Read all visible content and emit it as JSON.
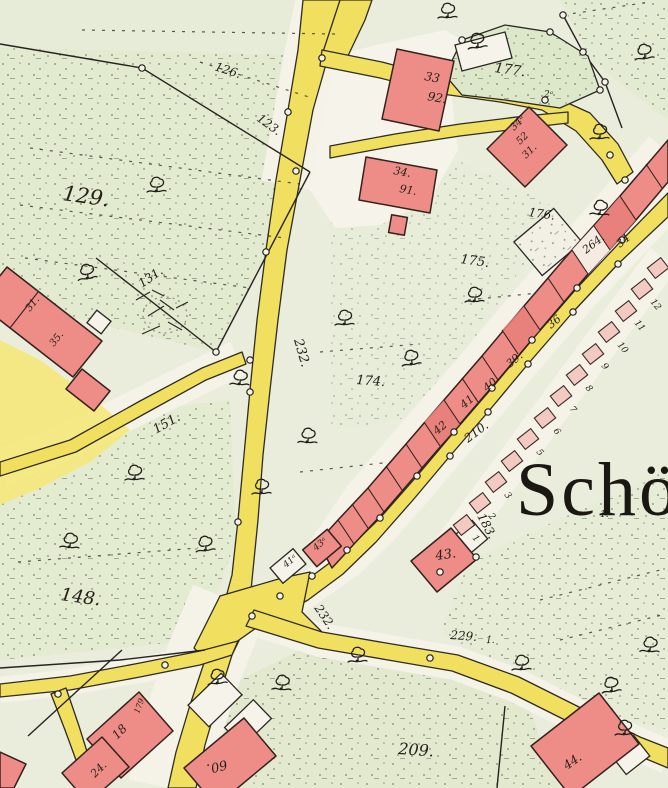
{
  "map": {
    "place_name": "Schö",
    "colors": {
      "road_yellow": "#f1e05f",
      "building_red": "#ee8d88",
      "plot_pink": "#f4c9c2",
      "field_green": "#e2ead0",
      "paper": "#eaeddc",
      "ink": "#241f18"
    },
    "labels": [
      {
        "text": "129.",
        "x": 62,
        "y": 200,
        "rot": 8,
        "size": 21,
        "cls": "parcel"
      },
      {
        "text": "126.",
        "x": 214,
        "y": 70,
        "rot": 18,
        "size": 12,
        "cls": "parcel"
      },
      {
        "text": "123.",
        "x": 256,
        "y": 120,
        "rot": 36,
        "size": 12,
        "cls": "parcel"
      },
      {
        "text": "131.",
        "x": 142,
        "y": 288,
        "rot": -35,
        "size": 12,
        "cls": "parcel"
      },
      {
        "text": "151.",
        "x": 156,
        "y": 434,
        "rot": -30,
        "size": 13,
        "cls": "parcel"
      },
      {
        "text": "148.",
        "x": 60,
        "y": 600,
        "rot": 8,
        "size": 18,
        "cls": "parcel"
      },
      {
        "text": "174.",
        "x": 356,
        "y": 384,
        "rot": 4,
        "size": 13,
        "cls": "parcel"
      },
      {
        "text": "175.",
        "x": 460,
        "y": 263,
        "rot": 8,
        "size": 13,
        "cls": "parcel"
      },
      {
        "text": "176.",
        "x": 528,
        "y": 216,
        "rot": 8,
        "size": 12,
        "cls": "parcel"
      },
      {
        "text": "177.",
        "x": 494,
        "y": 72,
        "rot": 8,
        "size": 14,
        "cls": "parcel"
      },
      {
        "text": "183.",
        "x": 477,
        "y": 516,
        "rot": 62,
        "size": 12,
        "cls": "parcel"
      },
      {
        "text": "209.",
        "x": 398,
        "y": 754,
        "rot": 4,
        "size": 16,
        "cls": "parcel"
      },
      {
        "text": "264.",
        "x": 586,
        "y": 254,
        "rot": -38,
        "size": 11,
        "cls": "parcel"
      },
      {
        "text": "1.",
        "x": 486,
        "y": 643,
        "rot": 0,
        "size": 9,
        "cls": "parcel"
      },
      {
        "text": "1.",
        "x": 600,
        "y": 517,
        "rot": 0,
        "size": 9,
        "cls": "parcel"
      },
      {
        "text": "2ᵃ",
        "x": 544,
        "y": 97,
        "rot": 0,
        "size": 9,
        "cls": "parcel"
      },
      {
        "text": "210.",
        "x": 468,
        "y": 443,
        "rot": -37,
        "size": 12,
        "cls": "road"
      },
      {
        "text": "229.",
        "x": 450,
        "y": 639,
        "rot": 4,
        "size": 12,
        "cls": "road"
      },
      {
        "text": "232.",
        "x": 294,
        "y": 340,
        "rot": 74,
        "size": 13,
        "cls": "road"
      },
      {
        "text": "232.",
        "x": 314,
        "y": 608,
        "rot": 56,
        "size": 12,
        "cls": "road"
      },
      {
        "text": "33",
        "x": 424,
        "y": 80,
        "rot": 10,
        "size": 12,
        "cls": "building"
      },
      {
        "text": "92.",
        "x": 427,
        "y": 100,
        "rot": 10,
        "size": 12,
        "cls": "building"
      },
      {
        "text": "34.",
        "x": 393,
        "y": 174,
        "rot": 10,
        "size": 11,
        "cls": "building"
      },
      {
        "text": "91.",
        "x": 399,
        "y": 192,
        "rot": 10,
        "size": 11,
        "cls": "building"
      },
      {
        "text": "34ᵃ",
        "x": 514,
        "y": 131,
        "rot": -45,
        "size": 10,
        "cls": "building"
      },
      {
        "text": "52",
        "x": 520,
        "y": 145,
        "rot": -45,
        "size": 10,
        "cls": "building"
      },
      {
        "text": "31.",
        "x": 526,
        "y": 159,
        "rot": -45,
        "size": 10,
        "cls": "building"
      },
      {
        "text": "34",
        "x": 620,
        "y": 248,
        "rot": -40,
        "size": 11,
        "cls": "building"
      },
      {
        "text": "36",
        "x": 551,
        "y": 329,
        "rot": -40,
        "size": 11,
        "cls": "building"
      },
      {
        "text": "39.",
        "x": 510,
        "y": 368,
        "rot": -40,
        "size": 11,
        "cls": "building"
      },
      {
        "text": "40",
        "x": 487,
        "y": 392,
        "rot": -40,
        "size": 11,
        "cls": "building"
      },
      {
        "text": "41.",
        "x": 464,
        "y": 409,
        "rot": -40,
        "size": 11,
        "cls": "building"
      },
      {
        "text": "42",
        "x": 437,
        "y": 435,
        "rot": -40,
        "size": 11,
        "cls": "building"
      },
      {
        "text": "43ᵃ",
        "x": 316,
        "y": 551,
        "rot": -40,
        "size": 9,
        "cls": "building"
      },
      {
        "text": "41ᵃ",
        "x": 286,
        "y": 568,
        "rot": -40,
        "size": 9,
        "cls": "building"
      },
      {
        "text": "43.",
        "x": 436,
        "y": 560,
        "rot": -8,
        "size": 13,
        "cls": "building"
      },
      {
        "text": "44.",
        "x": 567,
        "y": 770,
        "rot": -35,
        "size": 12,
        "cls": "building"
      },
      {
        "text": "18",
        "x": 117,
        "y": 740,
        "rot": -45,
        "size": 12,
        "cls": "building"
      },
      {
        "text": "24.",
        "x": 95,
        "y": 778,
        "rot": -45,
        "size": 11,
        "cls": "building"
      },
      {
        "text": "60.",
        "x": 226,
        "y": 760,
        "rot": 166,
        "size": 13,
        "cls": "building"
      },
      {
        "text": "179",
        "x": 139,
        "y": 714,
        "rot": -70,
        "size": 8,
        "cls": "building"
      },
      {
        "text": "31.",
        "x": 30,
        "y": 312,
        "rot": -52,
        "size": 10,
        "cls": "building"
      },
      {
        "text": "35.",
        "x": 54,
        "y": 347,
        "rot": -52,
        "size": 10,
        "cls": "building"
      },
      {
        "text": "12",
        "x": 650,
        "y": 302,
        "rot": 50,
        "size": 9,
        "cls": "plot"
      },
      {
        "text": "11",
        "x": 634,
        "y": 323,
        "rot": 50,
        "size": 9,
        "cls": "plot"
      },
      {
        "text": "10",
        "x": 617,
        "y": 345,
        "rot": 50,
        "size": 9,
        "cls": "plot"
      },
      {
        "text": "9",
        "x": 601,
        "y": 366,
        "rot": 50,
        "size": 9,
        "cls": "plot"
      },
      {
        "text": "8",
        "x": 585,
        "y": 388,
        "rot": 50,
        "size": 9,
        "cls": "plot"
      },
      {
        "text": "7",
        "x": 569,
        "y": 409,
        "rot": 50,
        "size": 9,
        "cls": "plot"
      },
      {
        "text": "6",
        "x": 553,
        "y": 431,
        "rot": 50,
        "size": 9,
        "cls": "plot"
      },
      {
        "text": "5",
        "x": 536,
        "y": 452,
        "rot": 50,
        "size": 9,
        "cls": "plot"
      },
      {
        "text": "4",
        "x": 520,
        "y": 474,
        "rot": 50,
        "size": 9,
        "cls": "plot"
      },
      {
        "text": "3",
        "x": 504,
        "y": 495,
        "rot": 50,
        "size": 9,
        "cls": "plot"
      },
      {
        "text": "2",
        "x": 488,
        "y": 516,
        "rot": 50,
        "size": 9,
        "cls": "plot"
      },
      {
        "text": "1",
        "x": 472,
        "y": 538,
        "rot": 50,
        "size": 9,
        "cls": "plot"
      }
    ]
  }
}
